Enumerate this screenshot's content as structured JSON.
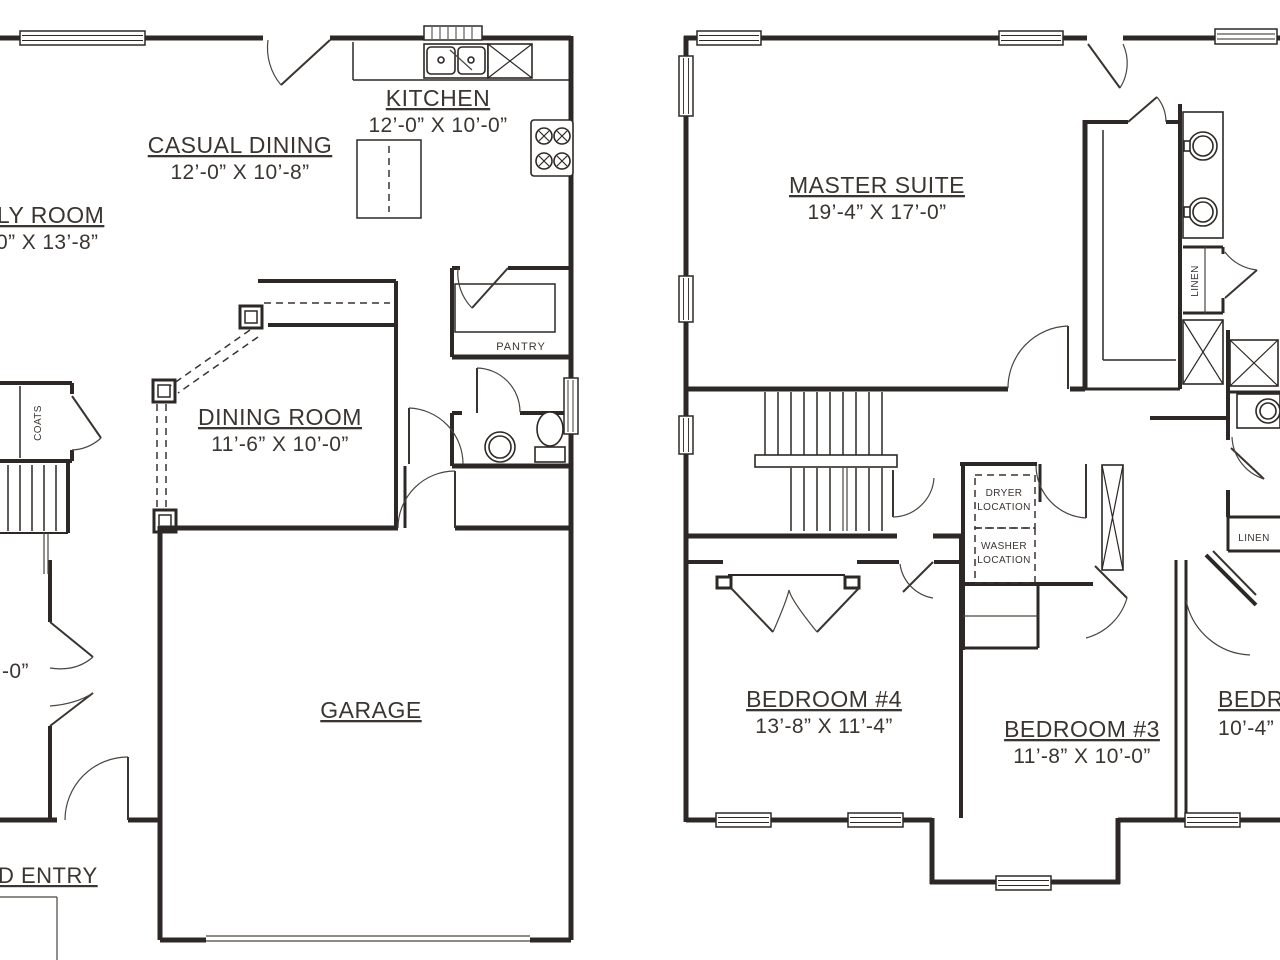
{
  "colors": {
    "line": "#2d2825",
    "text": "#3b3531",
    "background": "#ffffff"
  },
  "first": {
    "kitchen": {
      "name": "KITCHEN",
      "dims": "12’-0” X 10’-0”"
    },
    "casual": {
      "name": "CASUAL DINING",
      "dims": "12’-0” X 10’-8”"
    },
    "family": {
      "name": "ILY ROOM",
      "dims": "0” X 13’-8”"
    },
    "dining": {
      "name": "DINING ROOM",
      "dims": "11’-6” X 10’-0”"
    },
    "garage": {
      "name": "GARAGE"
    },
    "entry": {
      "name": "D ENTRY"
    },
    "foyer_dim": "-0”",
    "pantry": "PANTRY",
    "coats": "COATS"
  },
  "second": {
    "master": {
      "name": "MASTER SUITE",
      "dims": "19’-4” X 17’-0”"
    },
    "bed4": {
      "name": "BEDROOM #4",
      "dims": "13’-8” X 11’-4”"
    },
    "bed3": {
      "name": "BEDROOM #3",
      "dims": "11’-8” X 10’-0”"
    },
    "bed2": {
      "name": "BEDRO",
      "dims": "10’-4”"
    },
    "linen_bath": "LINEN",
    "linen_hall": "LINEN",
    "dryer": [
      "DRYER",
      "LOCATION"
    ],
    "washer": [
      "WASHER",
      "LOCATION"
    ]
  }
}
